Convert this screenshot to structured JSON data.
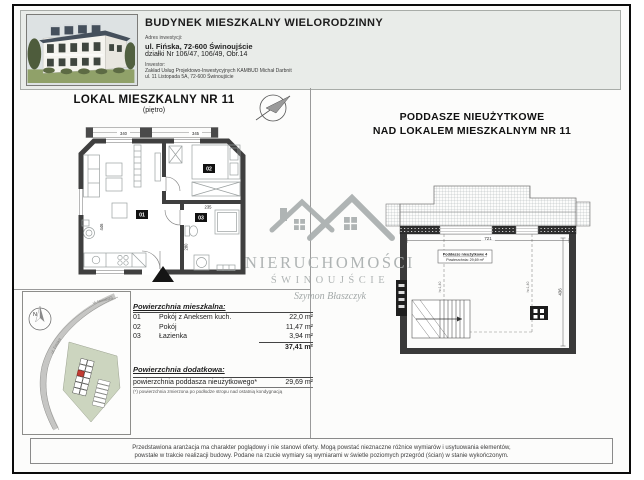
{
  "header": {
    "title": "BUDYNEK MIESZKALNY WIELORODZINNY",
    "address_label": "Adres inwestycji:",
    "address_line1": "ul. Fińska, 72-600 Świnoujście",
    "address_line2": "działki Nr 106/47, 106/49, Obr.14",
    "investor_label": "Inwestor:",
    "investor_line1": "Zakład Usług Projektowo-Inwestycyjnych KAMBUD Michał Darbnit",
    "investor_line2": "ul. 11 Listopada 5A, 72-600 Świnoujście"
  },
  "left_panel": {
    "title": "LOKAL MIESZKALNY NR 11",
    "subtitle": "(piętro)",
    "room_labels": {
      "r1": "01",
      "r2": "02",
      "r3": "03"
    },
    "dims": {
      "top_left": "340",
      "top_right": "345",
      "bath": "235",
      "left": "446",
      "bath_side": "280"
    }
  },
  "right_panel": {
    "title_line1": "PODDASZE NIEUŻYTKOWE",
    "title_line2": "NAD LOKALEM MIESZKALNYM NR 11",
    "plan_label_line1": "Poddasze nieużytkowe 4",
    "plan_label_line2": "Powierzchnia: 29,69 m²",
    "dims": {
      "width": "721",
      "height": "436",
      "knee": "h=1,40"
    }
  },
  "site_map": {
    "north": "N",
    "street1": "ul. Fińska",
    "street2": "ul. Norweska"
  },
  "areas": {
    "residential_header": "Powierzchnia mieszkalna:",
    "rows": [
      {
        "no": "01",
        "name": "Pokój z Aneksem kuch.",
        "value": "22,0 m²"
      },
      {
        "no": "02",
        "name": "Pokój",
        "value": "11,47 m²"
      },
      {
        "no": "03",
        "name": "Łazienka",
        "value": "3,94 m²"
      }
    ],
    "total": "37,41 m²",
    "additional_header": "Powierzchnia dodatkowa:",
    "additional_name": "powierzchnia poddasza nieużytkowego*",
    "additional_value": "29,69 m²",
    "footnote": "(*) powierzchnia zmierzona po podłodze stropu nad ostatnią kondygnacją"
  },
  "watermark": {
    "line1": "NIERUCHOMOŚCI",
    "line2": "ŚWINOUJŚCIE",
    "signature": "Szymon Błaszczyk"
  },
  "disclaimer": {
    "line1": "Przedstawiona aranżacja ma charakter poglądowy i nie stanowi oferty. Mogą powstać nieznaczne różnice wymiarów i usytuowania elementów,",
    "line2": "powstałe w trakcie realizacji budowy. Podane na rzucie wymiary są wymiarami w świetle poziomych przegród (ścian) w stanie wykończonym."
  }
}
